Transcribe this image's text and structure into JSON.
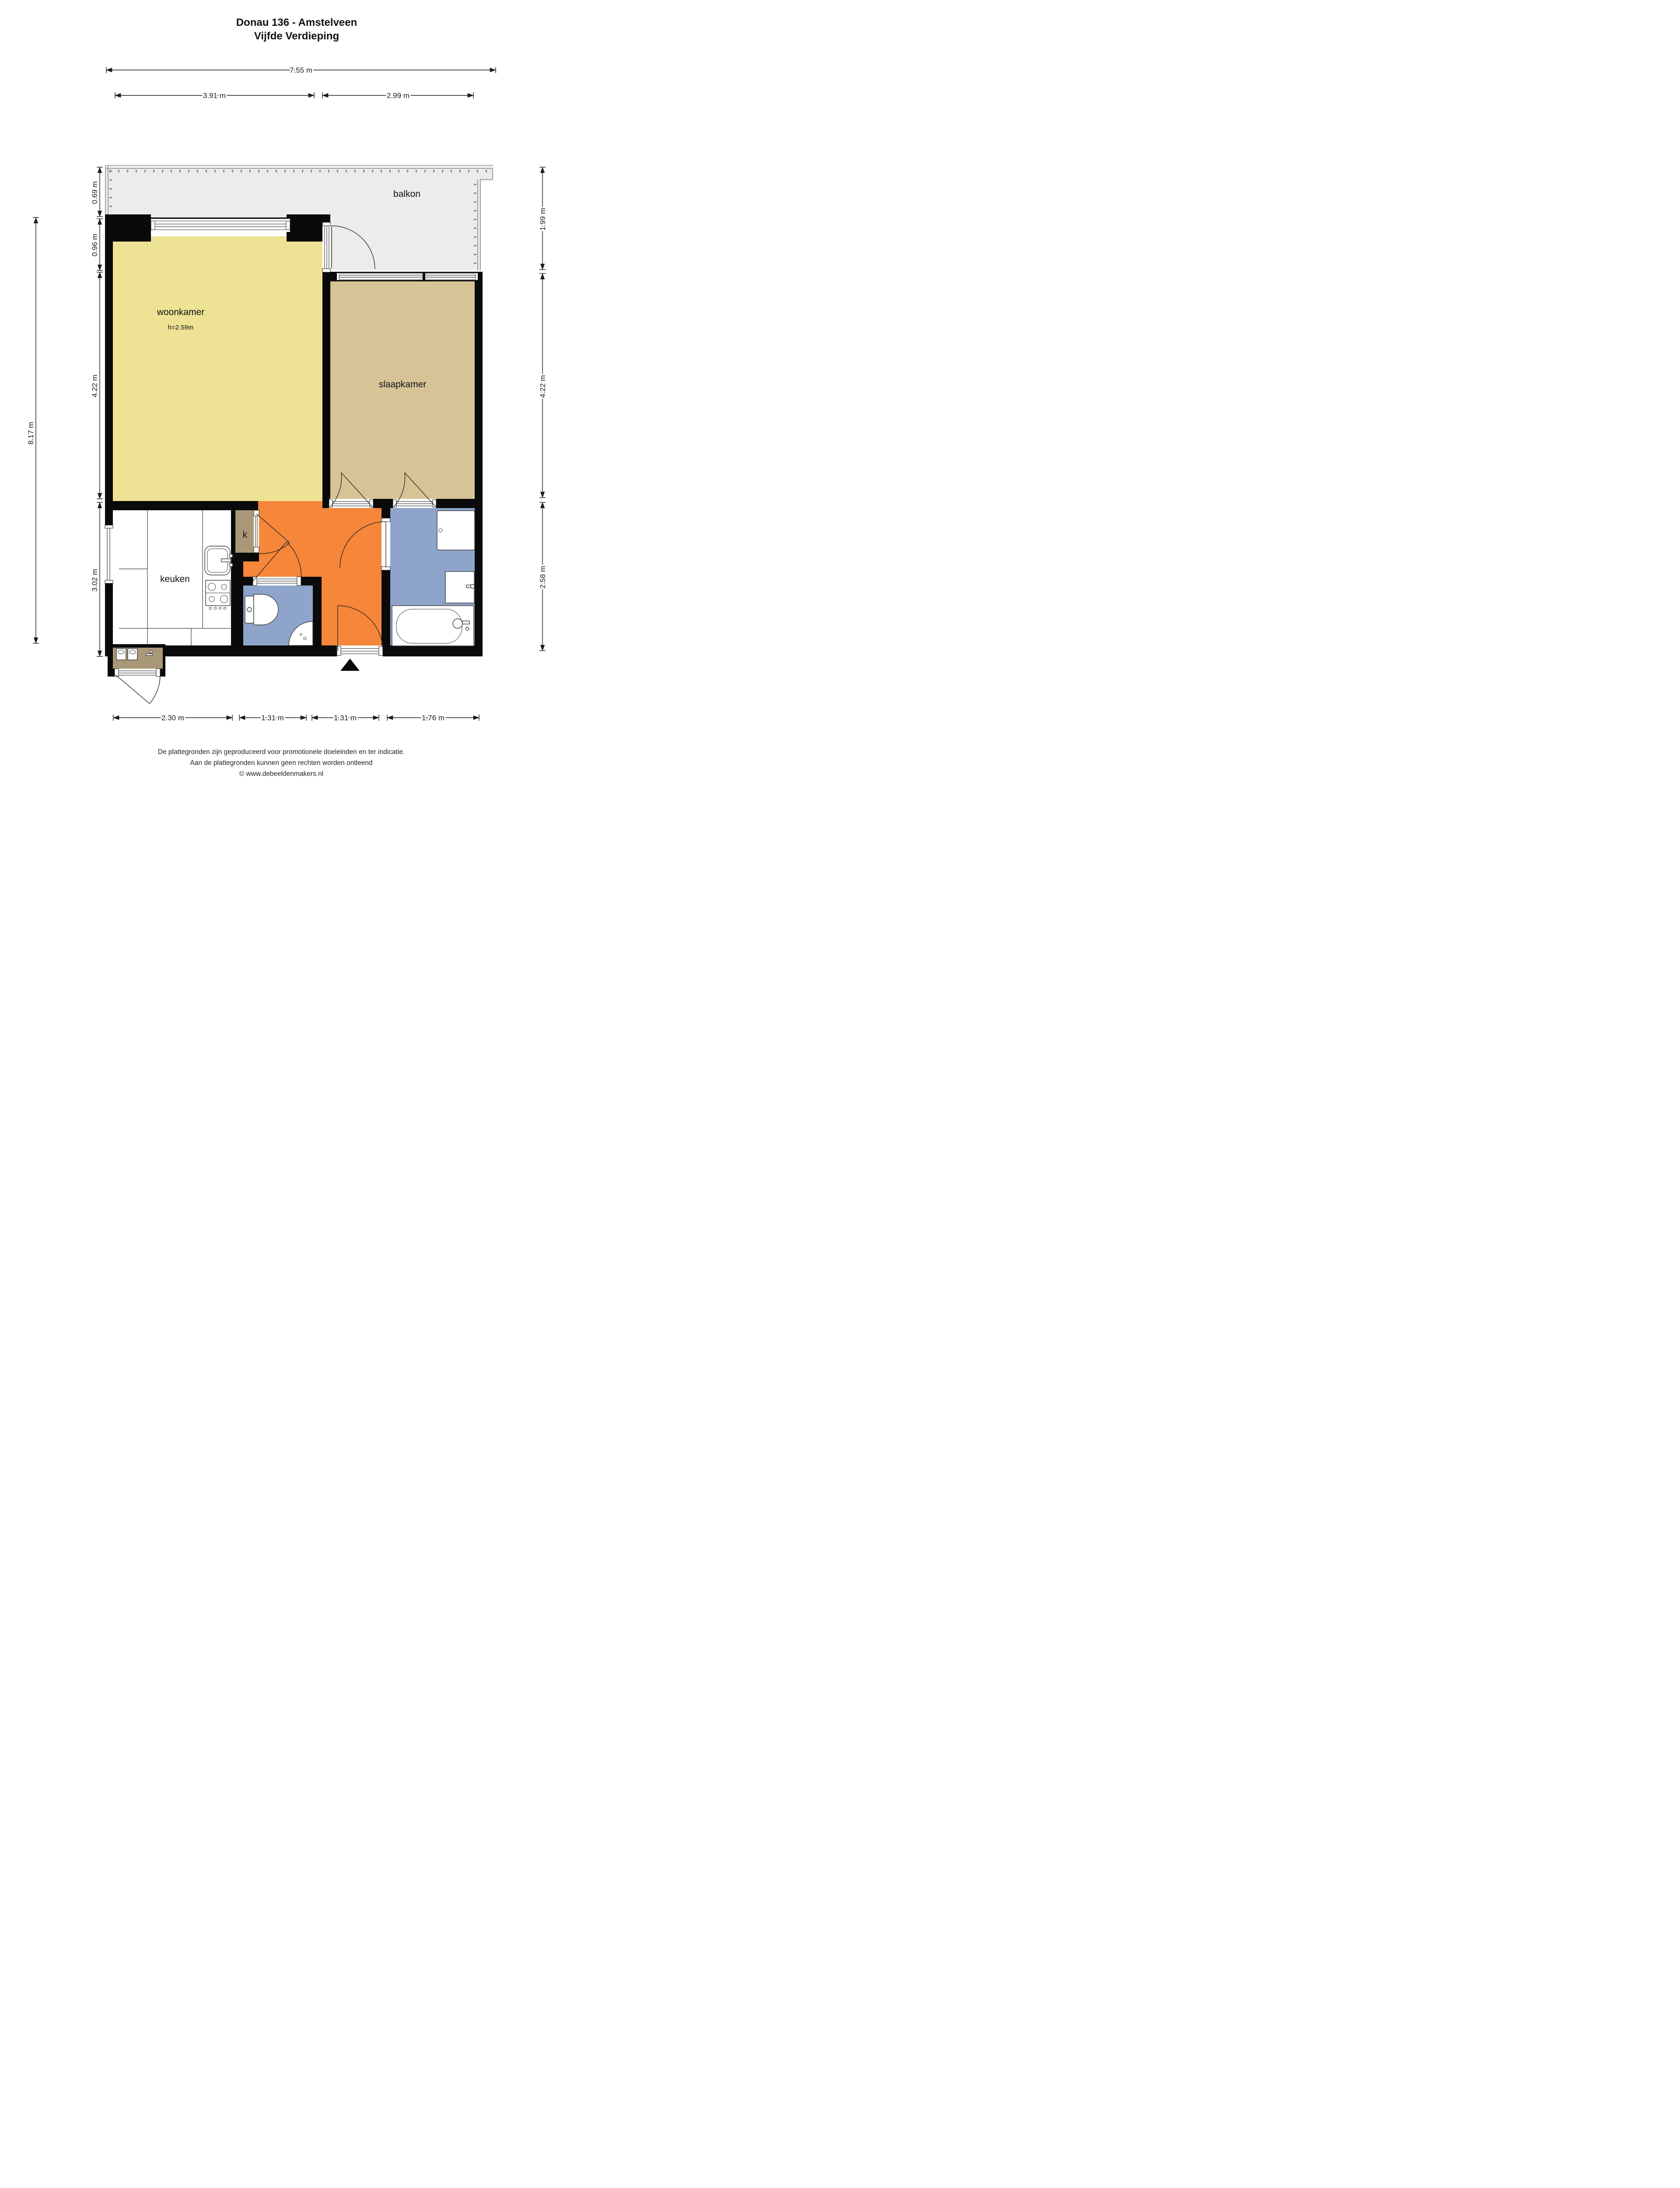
{
  "title": {
    "line1": "Donau 136 - Amstelveen",
    "line2": "Vijfde Verdieping"
  },
  "rooms": {
    "balkon": "balkon",
    "woonkamer": "woonkamer",
    "woonkamer_height": "h=2.59m",
    "slaapkamer": "slaapkamer",
    "keuken": "keuken",
    "kast": "k",
    "hal": "hal"
  },
  "dimensions": {
    "top_total": "7.55 m",
    "top_left": "3.91 m",
    "top_right": "2.99 m",
    "left_outer": "8.17 m",
    "left_0": "0.69 m",
    "left_1": "0.96 m",
    "left_2": "4.22 m",
    "left_3": "3.02 m",
    "right_0": "1.99 m",
    "right_1": "4.22 m",
    "right_2": "2.58 m",
    "bottom_0": "2.30 m",
    "bottom_1": "1.31 m",
    "bottom_2": "1.31 m",
    "bottom_3": "1.76 m"
  },
  "footer": {
    "line1": "De plattegronden zijn geproduceerd voor promotionele doeleinden en ter indicatie.",
    "line2": "Aan de plattegronden kunnen geen rechten worden ontleend",
    "line3": "© www.debeeldenmakers.nl"
  },
  "colors": {
    "wall": "#0a0a0a",
    "woonkamer": "#eee295",
    "slaapkamer": "#d6c497",
    "hal": "#f5863a",
    "badkamer": "#8ea4cb",
    "kast": "#a99878",
    "balkon": "#ececea",
    "line": "#1c1c1c",
    "rail": "#8a8a8a"
  }
}
